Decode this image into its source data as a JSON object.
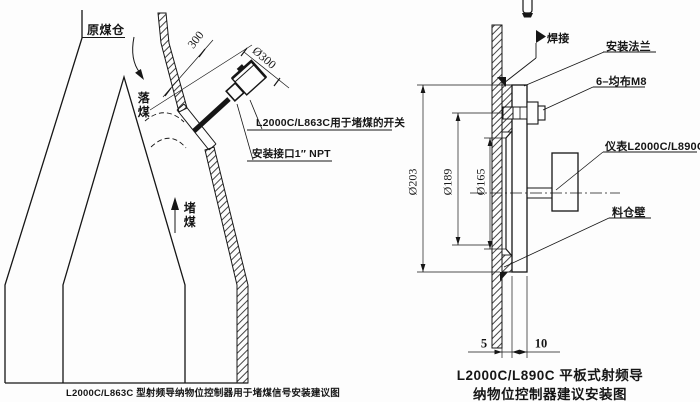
{
  "left": {
    "caption": "L2000C/L863C 型射频导纳物位控制器用于堵煤信号安装建议图",
    "bunker_label": "原煤仓",
    "falling_coal_label": "落煤",
    "blocked_coal_label": "堵煤",
    "switch_note": "L2000C/L863C用于堵煤的开关",
    "npt_note": "安装接口1″ NPT",
    "dim_300": "300",
    "dim_dia300": "Ø300"
  },
  "right": {
    "caption_line1": "L2000C/L890C 平板式射频导",
    "caption_line2": "纳物位控制器建议安装图",
    "weld_label": "焊接",
    "flange_label": "安装法兰",
    "bolt_label": "6–均布M8",
    "instrument_label": "仪表L2000C/L890C",
    "wall_label": "料仓壁",
    "dim_203": "Ø203",
    "dim_189": "Ø189",
    "dim_165": "Ø165",
    "dim_5": "5",
    "dim_10": "10"
  },
  "colors": {
    "ink": "#161616",
    "background": "#fdfdfd"
  }
}
